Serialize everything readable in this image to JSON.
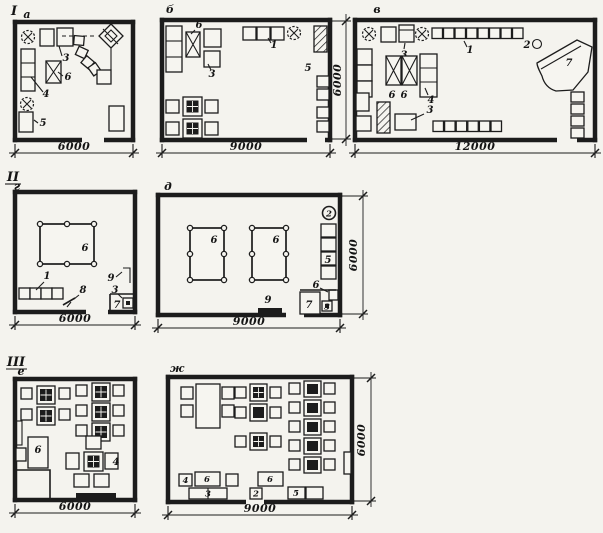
{
  "colors": {
    "paper": "#f4f3ee",
    "ink": "#1c1c1c"
  },
  "plans": {
    "a": {
      "group": "I",
      "letter": "а",
      "dim_width": "6000",
      "labels": {
        "n3": "3",
        "n4": "4",
        "n5": "5",
        "n6": "6"
      }
    },
    "b": {
      "letter": "б",
      "dim_width": "9000",
      "dim_height": "6000",
      "labels": {
        "n1": "1",
        "n3": "3",
        "n5": "5",
        "n6": "6"
      }
    },
    "v": {
      "letter": "в",
      "dim_width": "12000",
      "labels": {
        "n1": "1",
        "n2": "2",
        "n3a": "3",
        "n3b": "3",
        "n4": "4",
        "n6a": "6",
        "n6b": "6",
        "n7": "7"
      }
    },
    "g": {
      "group": "II",
      "letter": "г",
      "dim_width": "6000",
      "labels": {
        "n1": "1",
        "n3": "3",
        "n6": "6",
        "n7": "7",
        "n8": "8",
        "n9": "9"
      }
    },
    "d": {
      "letter": "д",
      "dim_width": "9000",
      "dim_height": "6000",
      "labels": {
        "n2": "2",
        "n3": "3",
        "n5": "5",
        "n6a": "6",
        "n6b": "6",
        "n6c": "6",
        "n7": "7",
        "n9": "9"
      }
    },
    "e": {
      "group": "III",
      "letter": "е",
      "dim_width": "6000",
      "labels": {
        "n4": "4",
        "n6": "6"
      }
    },
    "zh": {
      "letter": "ж",
      "dim_width": "9000",
      "dim_height": "6000",
      "labels": {
        "n2": "2",
        "n3": "3",
        "n4": "4",
        "n5": "5",
        "n6a": "6",
        "n6b": "6"
      }
    }
  }
}
